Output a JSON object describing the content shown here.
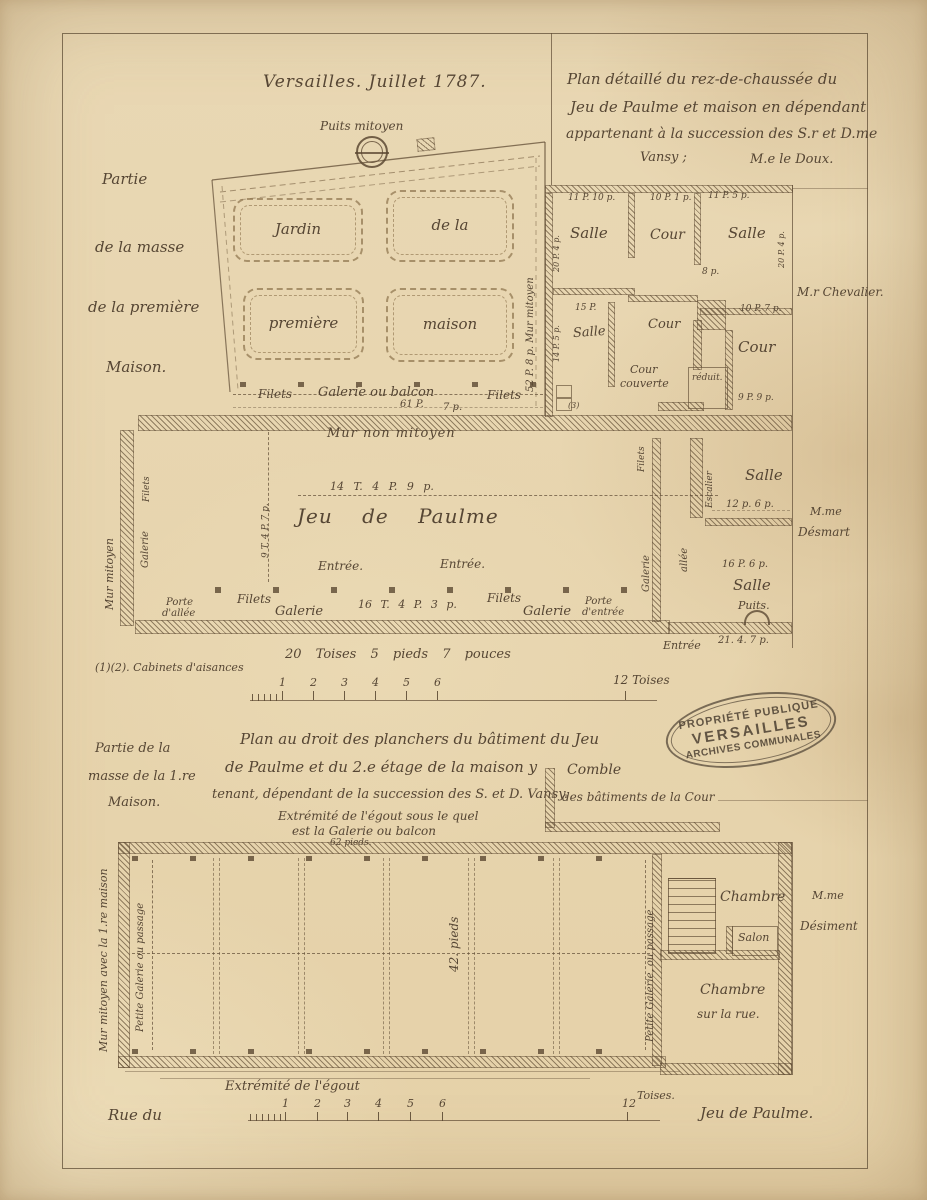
{
  "colors": {
    "paper": "#e8d7b2",
    "ink": "#564634"
  },
  "header": {
    "place_date": "Versailles. Juillet 1787.",
    "title": {
      "l1": "Plan détaillé du rez-de-chaussée du",
      "l2": "Jeu de Paulme et maison en dépendant",
      "l3": "appartenant à la succession des S.r et D.me",
      "l4": "Vansy ;",
      "author": "M.e le Doux."
    }
  },
  "left_note": {
    "l1": "Partie",
    "l2": "de la masse",
    "l3": "de la première",
    "l4": "Maison."
  },
  "garden": {
    "well": "Puits mitoyen",
    "parterres": [
      "Jardin",
      "de la",
      "première",
      "maison"
    ],
    "wall_label": "52 P. 8 p.  Mur mitoyen",
    "filets_left": "Filets",
    "galerie": "Galerie ou balcon",
    "m1": "61 P.",
    "m2": "7 p.",
    "filets_right": "Filets"
  },
  "house": {
    "r1a_m": "11 P. 10 p.",
    "r1a": "Salle",
    "r1b_m": "10 P. 1 p.",
    "r1b": "Cour",
    "r1c_m": "11 P. 5 p.",
    "r1c": "Salle",
    "v1": "20 P. 4 p.",
    "v2": "20 P. 4 p.",
    "m8p": "8 p.",
    "r2a_m1": "15 P.",
    "r2a_m2": "14 P. 5 p.",
    "r2a": "Salle",
    "r2b": "Cour",
    "cc1": "Cour",
    "cc2": "couverte",
    "reduit": "réduit.",
    "r2d": "Cour",
    "r2d_m": "10 P. 7 p.",
    "m99": "9 P. 9 p.",
    "n3": "(3)",
    "neighbor": "M.r Chevalier."
  },
  "hall": {
    "top_wall": "Mur non mitoyen",
    "measure": "14 T. 4 P. 9 p.",
    "name": "Jeu  de  Paulme",
    "entree1": "Entrée.",
    "entree2": "Entrée.",
    "vmeasure": "9 T. 4 P. 7 p.",
    "mur_mitoyen": "Mur mitoyen",
    "filets_v": "Filets",
    "galerie_v": "Galerie",
    "porte1a": "Porte",
    "porte1b": "d'allée",
    "filets1": "Filets",
    "galerie1": "Galerie",
    "measure2": "16 T. 4 P. 3 p.",
    "filets2": "Filets",
    "galerie2": "Galerie",
    "porte2a": "Porte",
    "porte2b": "d'entrée",
    "wing": {
      "filets_v": "Filets",
      "galerie_v": "Galerie",
      "allee_v": "allée",
      "escalier_v": "Escalier",
      "salle1": "Salle",
      "salle1_m": "12 p. 6 p.",
      "salle2": "Salle",
      "salle2_m": "16 P. 6 p.",
      "puits": "Puits.",
      "entree": "Entrée",
      "m": "21. 4. 7 p."
    },
    "neighbor1": "M.me",
    "neighbor2": "Désmart"
  },
  "midscale": {
    "note": "(1)(2). Cabinets d'aisances",
    "length": "20 Toises   5 pieds   7 pouces",
    "numbers": [
      "1",
      "2",
      "3",
      "4",
      "5",
      "6"
    ],
    "end": "12 Toises"
  },
  "stamp": {
    "l1": "PROPRIÉTÉ PUBLIQUE",
    "l2": "VERSAILLES",
    "l3": "ARCHIVES COMMUNALES"
  },
  "lower_title": {
    "l1": "Plan  au droit des planchers du bâtiment du Jeu",
    "l2": "de Paulme et du 2.e étage de la maison y",
    "l3": "tenant, dépendant de la succession des S. et D. Vansy.",
    "l4": "Extrémité de l'égout sous le quel",
    "l5": "est la Galerie ou balcon",
    "l6": "62 pieds.",
    "comble1": "Comble",
    "comble2": "des bâtiments de la Cour"
  },
  "lower_left": {
    "l1": "Partie de la",
    "l2": "masse de la 1.re",
    "l3": "Maison."
  },
  "floorplan": {
    "mur_v": "Mur mitoyen avec la 1.re maison",
    "galerie_v_left": "Petite Galerie ou passage",
    "pieds": "42. pieds",
    "galerie_v_right": "Petite Galerie, ou passage",
    "chambre1": "Chambre",
    "salon": "Salon",
    "chambre2": "Chambre",
    "chambre2b": "sur la rue.",
    "neighbor1": "M.me",
    "neighbor2": "Désiment"
  },
  "footer": {
    "egout": "Extrémité de l'égout",
    "street1": "Rue du",
    "numbers": [
      "1",
      "2",
      "3",
      "4",
      "5",
      "6"
    ],
    "twelve": "12",
    "toises": "Toises.",
    "street2": "Jeu de Paulme."
  }
}
